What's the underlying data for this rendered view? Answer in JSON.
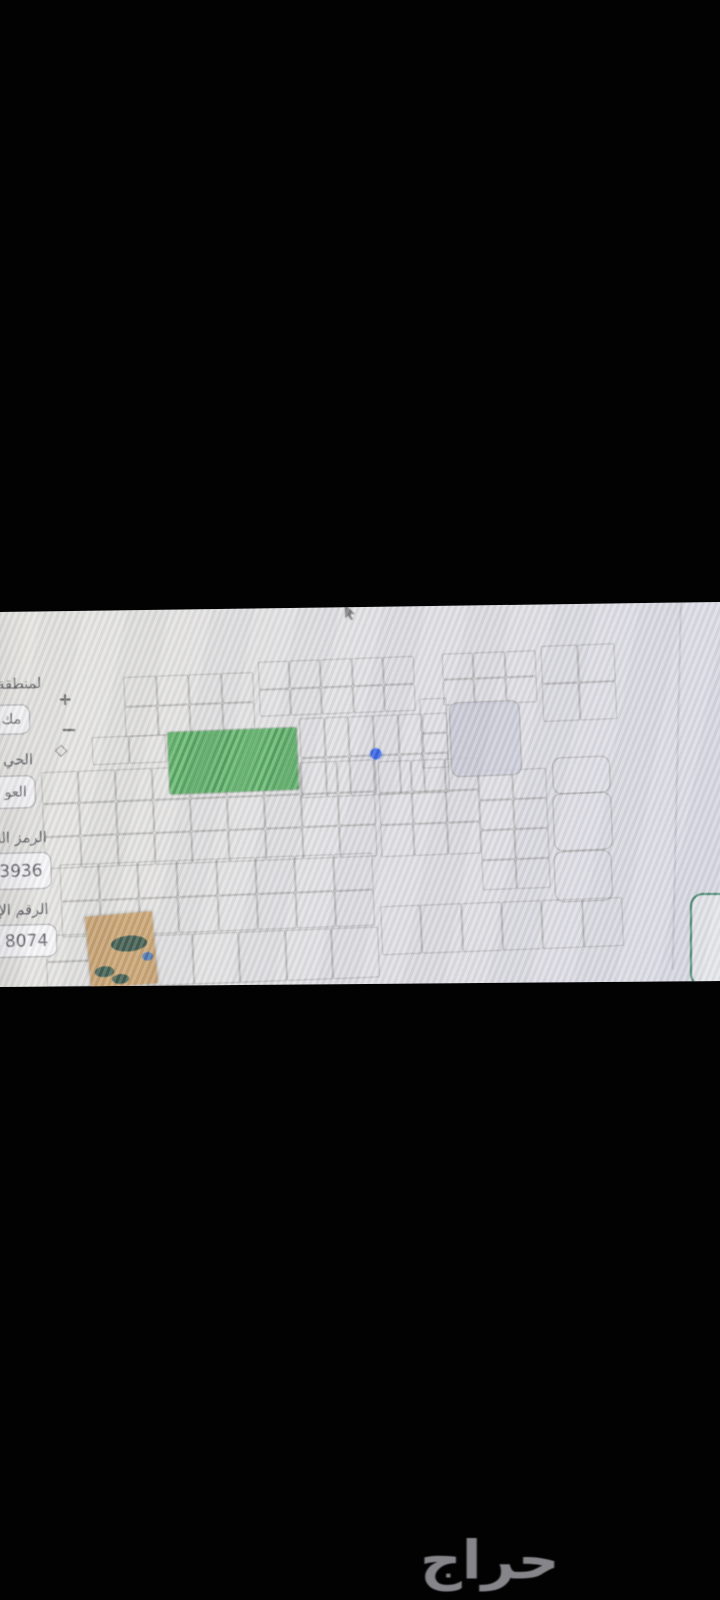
{
  "photo_band": {
    "form": {
      "fields": [
        {
          "id": "region",
          "label": "لمنطقة",
          "value": "مك"
        },
        {
          "id": "district",
          "label": "الحي",
          "value": "العو"
        },
        {
          "id": "postal_code",
          "label": "الرمز الب",
          "value": "3936"
        },
        {
          "id": "additional_number",
          "label": "الرقم الإ",
          "value": "8074"
        }
      ]
    },
    "map": {
      "controls": {
        "zoom_in": "+",
        "zoom_out": "−",
        "compass": "◇"
      },
      "colors": {
        "highlight_parcel": "#56b160",
        "selected_marker": "#2253e4",
        "shaded_parcel": "#c6c5d3",
        "map_background": "#dddce0",
        "parcel_line": "#68695f",
        "action_button_border": "#2e7a5c"
      }
    }
  },
  "watermark": {
    "text": "حراج",
    "color": "#85858a"
  }
}
